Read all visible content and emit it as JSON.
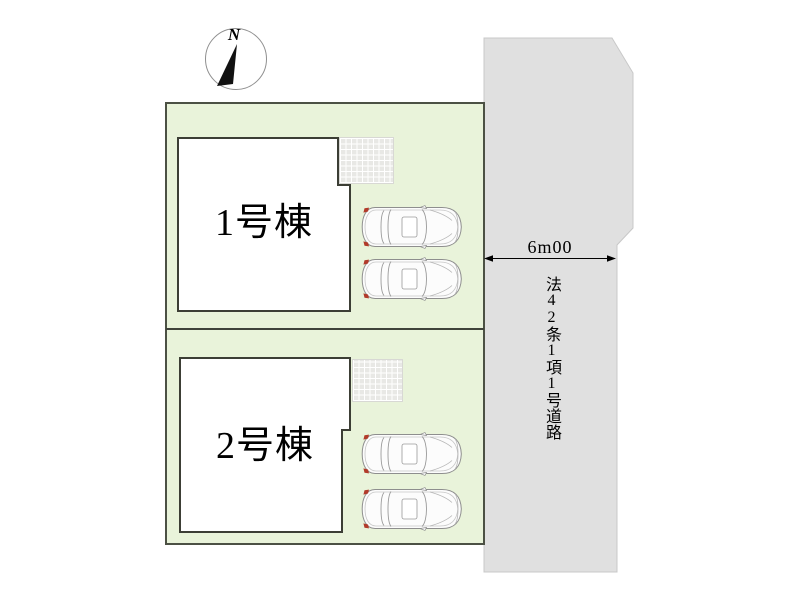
{
  "compass": {
    "label": "N"
  },
  "site": {
    "lots": [
      {
        "building_label": "1号棟",
        "cars_parked": 2,
        "has_terrace_grid": true
      },
      {
        "building_label": "2号棟",
        "cars_parked": 2,
        "has_terrace_grid": true
      }
    ]
  },
  "road": {
    "width_label": "6m00",
    "name": "法42条1項1号道路"
  },
  "colors": {
    "lot_fill": "#e9f3da",
    "lot_border": "#4c5144",
    "building_fill": "#ffffff",
    "building_border": "#3c3e35",
    "road_fill": "#e0e0e0",
    "road_border": "#c8c8c8",
    "terrace_tile": "#e8e8e5",
    "taillight_red": "#b23b2a",
    "text": "#000000"
  },
  "icons": {
    "compass": "north-compass-icon",
    "car": "car-top-view-icon"
  }
}
